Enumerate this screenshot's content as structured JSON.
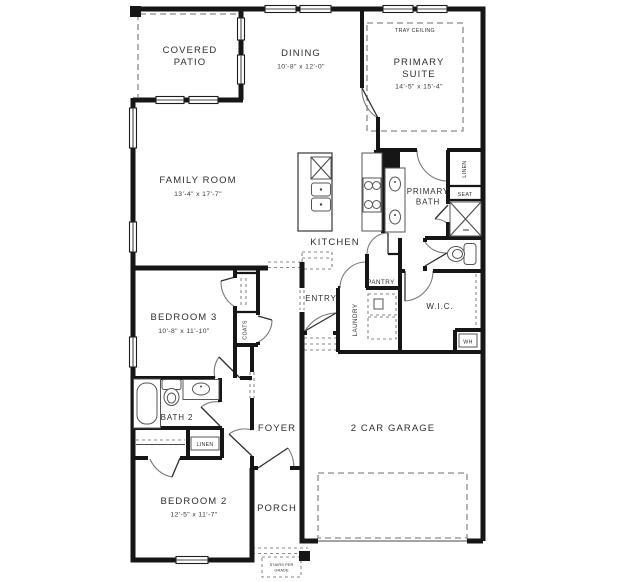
{
  "colors": {
    "wall": "#161616",
    "text": "#2f2f2f",
    "dashed_lines": "#8a8a8a",
    "background": "#ffffff"
  },
  "rooms": {
    "covered_patio": {
      "lines": [
        "COVERED",
        "PATIO"
      ]
    },
    "dining": {
      "lines": [
        "DINING"
      ],
      "dims": "10'-8\" x 12'-0\""
    },
    "primary_suite": {
      "lines": [
        "PRIMARY",
        "SUITE"
      ],
      "dims": "14'-5\" x 15'-4\"",
      "note": "TRAY CEILING"
    },
    "family_room": {
      "lines": [
        "FAMILY ROOM"
      ],
      "dims": "13'-4\" x 17'-7\""
    },
    "kitchen": {
      "lines": [
        "KITCHEN"
      ]
    },
    "primary_bath": {
      "lines": [
        "PRIMARY",
        "BATH"
      ]
    },
    "bedroom3": {
      "lines": [
        "BEDROOM 3"
      ],
      "dims": "10'-8\" x 11'-10\""
    },
    "bath2": {
      "lines": [
        "BATH 2"
      ]
    },
    "foyer": {
      "lines": [
        "FOYER"
      ]
    },
    "bedroom2": {
      "lines": [
        "BEDROOM 2"
      ],
      "dims": "12'-5\" x 11'-7\""
    },
    "porch": {
      "lines": [
        "PORCH"
      ]
    },
    "garage": {
      "lines": [
        "2 CAR GARAGE"
      ]
    },
    "entry": {
      "lines": [
        "ENTRY"
      ]
    },
    "pantry": {
      "lines": [
        "PANTRY"
      ]
    },
    "laundry": {
      "lines": [
        "LAUNDRY"
      ]
    },
    "wic": {
      "lines": [
        "W.I.C."
      ]
    }
  },
  "closets": {
    "coats": "COATS",
    "linen_primary": "LINEN",
    "linen_hall": "LINEN",
    "seat": "SEAT",
    "water_heater": "WH"
  },
  "annotations": {
    "stairs": {
      "lines": [
        "STAIRS PER",
        "GRADE"
      ]
    }
  }
}
